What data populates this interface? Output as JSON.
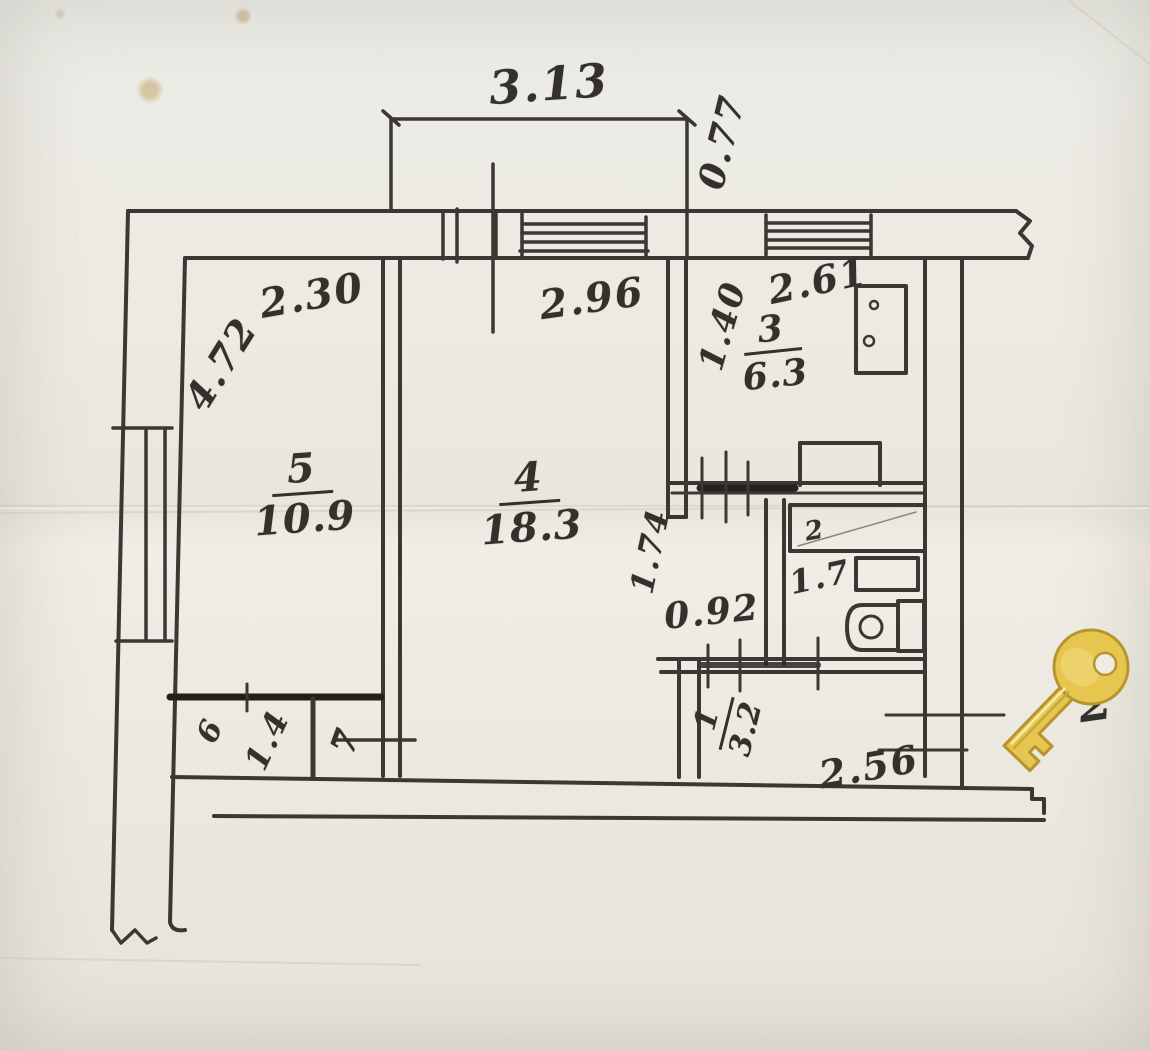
{
  "plan": {
    "dims": {
      "balcony_width": "3.13",
      "balcony_depth": "0.77",
      "room5_width": "2.30",
      "room5_depth": "4.72",
      "room4_width": "2.96",
      "kitchen_width": "2.61",
      "kitchen_depth": "1.40",
      "inner_wall": "1.74",
      "doorway": "0.92",
      "hall_width": "2.56",
      "closet_width": "1.4"
    },
    "rooms": {
      "r1": {
        "num": "1",
        "area": "3.2"
      },
      "r2": {
        "num": "2",
        "area": "1.7"
      },
      "r3": {
        "num": "3",
        "area": "6.3"
      },
      "r4": {
        "num": "4",
        "area": "18.3"
      },
      "r5": {
        "num": "5",
        "area": "10.9"
      },
      "r6": {
        "num": "6"
      },
      "r7": {
        "num": "7"
      }
    },
    "overlay": {
      "partial_digit": "2"
    }
  }
}
